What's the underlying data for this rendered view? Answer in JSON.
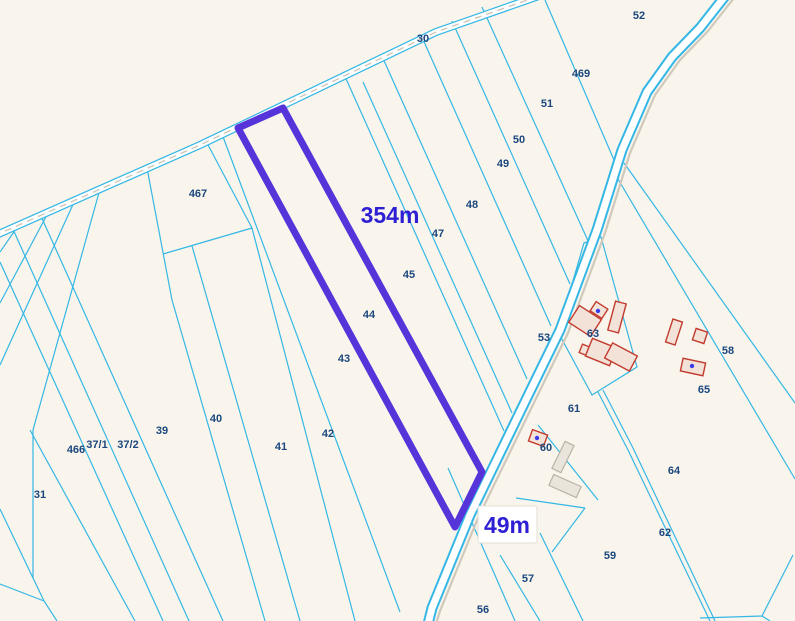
{
  "map": {
    "type": "cadastral-parcel-map",
    "highlighted_parcel": "44",
    "measurements": {
      "length_label": "354m",
      "width_label": "49m"
    },
    "colors": {
      "background": "#f9f5ec",
      "parcel_line": "#35b7e5",
      "highlight": "#5634d9",
      "parcel_label": "#1b477e",
      "measurement_text": "#2e1fd4",
      "road_fill": "#ffffff",
      "road_shadow": "#d0c8bb",
      "building_outline": "#c23b2e",
      "building_fill": "#f3e2d8",
      "utility_building_fill": "#e9e5dc",
      "building_point": "#3b3bea"
    },
    "parcels": [
      {
        "label": "30",
        "x": 423,
        "y": 42
      },
      {
        "label": "52",
        "x": 639,
        "y": 19
      },
      {
        "label": "469",
        "x": 581,
        "y": 77
      },
      {
        "label": "51",
        "x": 547,
        "y": 107
      },
      {
        "label": "50",
        "x": 519,
        "y": 143
      },
      {
        "label": "49",
        "x": 503,
        "y": 167
      },
      {
        "label": "48",
        "x": 472,
        "y": 208
      },
      {
        "label": "47",
        "x": 438,
        "y": 237
      },
      {
        "label": "45",
        "x": 409,
        "y": 278
      },
      {
        "label": "44",
        "x": 369,
        "y": 318
      },
      {
        "label": "43",
        "x": 344,
        "y": 362
      },
      {
        "label": "42",
        "x": 328,
        "y": 437
      },
      {
        "label": "41",
        "x": 281,
        "y": 450
      },
      {
        "label": "40",
        "x": 216,
        "y": 422
      },
      {
        "label": "39",
        "x": 162,
        "y": 434
      },
      {
        "label": "37/1",
        "x": 97,
        "y": 448
      },
      {
        "label": "37/2",
        "x": 128,
        "y": 448
      },
      {
        "label": "466",
        "x": 76,
        "y": 453
      },
      {
        "label": "31",
        "x": 40,
        "y": 498
      },
      {
        "label": "467",
        "x": 198,
        "y": 197
      },
      {
        "label": "53",
        "x": 544,
        "y": 341
      },
      {
        "label": "63",
        "x": 593,
        "y": 337
      },
      {
        "label": "58",
        "x": 728,
        "y": 354
      },
      {
        "label": "65",
        "x": 704,
        "y": 393
      },
      {
        "label": "61",
        "x": 574,
        "y": 412
      },
      {
        "label": "60",
        "x": 546,
        "y": 451
      },
      {
        "label": "64",
        "x": 674,
        "y": 474
      },
      {
        "label": "62",
        "x": 665,
        "y": 536
      },
      {
        "label": "59",
        "x": 610,
        "y": 559
      },
      {
        "label": "57",
        "x": 528,
        "y": 582
      },
      {
        "label": "56",
        "x": 483,
        "y": 613
      }
    ]
  }
}
